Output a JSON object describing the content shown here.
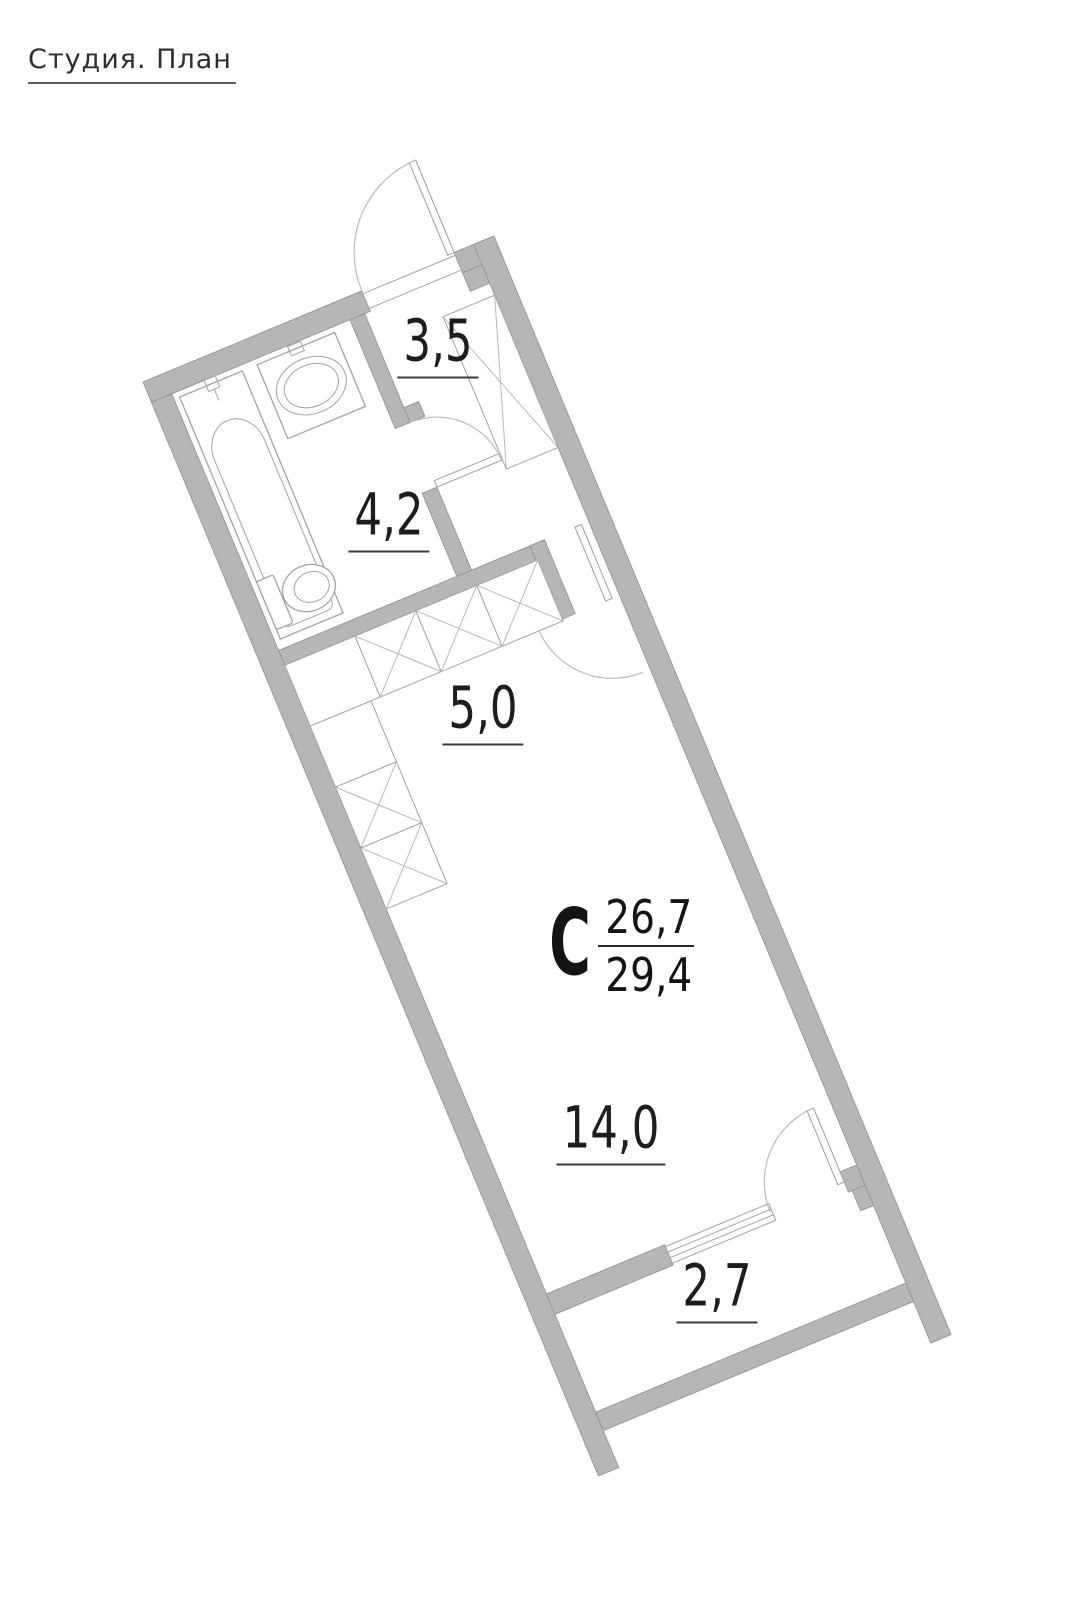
{
  "title": "Студия. План",
  "unit": {
    "type_letter": "С",
    "living_area": "26,7",
    "total_area": "29,4"
  },
  "rooms": [
    {
      "name": "hallway",
      "area": "3,5"
    },
    {
      "name": "bathroom",
      "area": "4,2"
    },
    {
      "name": "kitchen",
      "area": "5,0"
    },
    {
      "name": "living-room",
      "area": "14,0"
    },
    {
      "name": "balcony",
      "area": "2,7"
    }
  ],
  "colors": {
    "wall_fill": "#b6b6b6",
    "wall_stroke": "#8f8f8f",
    "fixture_stroke": "#a3a3a3",
    "arc_stroke": "#bcbcbc",
    "label_color": "#1d1d1d"
  }
}
